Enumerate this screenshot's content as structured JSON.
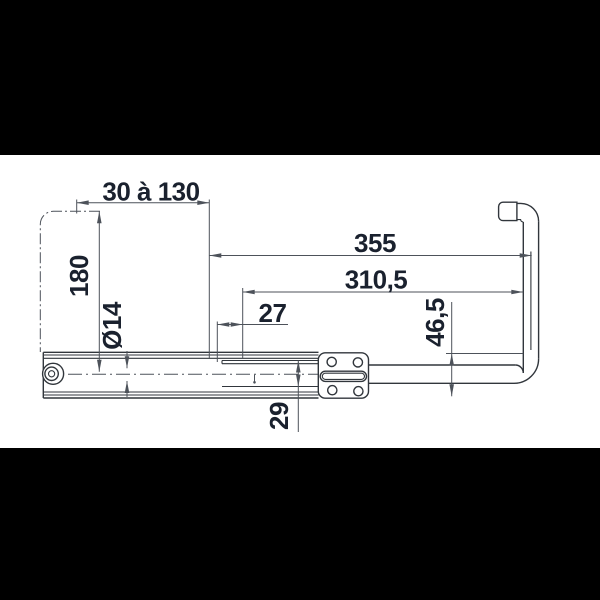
{
  "drawing": {
    "kind": "technical dimensioned drawing",
    "part": "telescopic-slide-with-return-tube",
    "background": "#000000",
    "paper": "#ffffff",
    "line_color": "#31363c",
    "dim_line_color": "#4d525a",
    "text_color": "#1a212e"
  },
  "dimensions": [
    {
      "id": "extension-range",
      "label": "30 à 130",
      "orientation": "horizontal"
    },
    {
      "id": "height-180",
      "label": "180",
      "orientation": "vertical"
    },
    {
      "id": "diameter-14",
      "label": "Ø14",
      "orientation": "vertical"
    },
    {
      "id": "offset-27",
      "label": "27",
      "orientation": "horizontal"
    },
    {
      "id": "length-355",
      "label": "355",
      "orientation": "horizontal"
    },
    {
      "id": "length-310-5",
      "label": "310,5",
      "orientation": "horizontal"
    },
    {
      "id": "height-46-5",
      "label": "46,5",
      "orientation": "vertical"
    },
    {
      "id": "height-29",
      "label": "29",
      "orientation": "vertical"
    }
  ]
}
